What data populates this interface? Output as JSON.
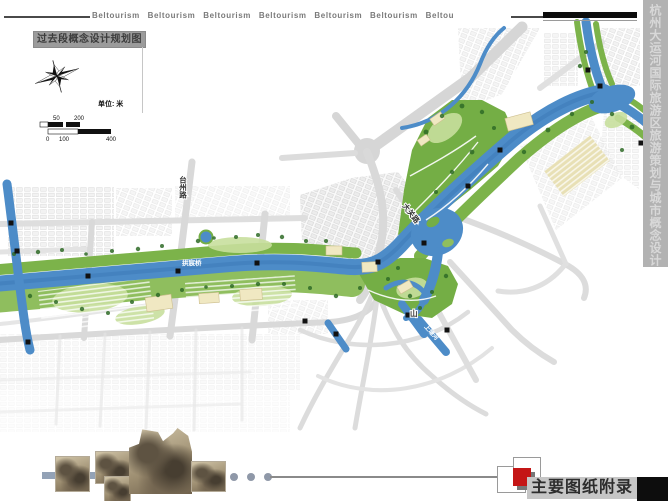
{
  "page": {
    "width": 668,
    "height": 501
  },
  "header": {
    "brand_line": "Beltourism Beltourism Beltourism Beltourism Beltourism Beltourism Beltou"
  },
  "title_box": {
    "label": "过去段概念设计规划图"
  },
  "sidebar": {
    "vertical_title": "杭州大运河国际旅游区旅游策划与城市概念设计"
  },
  "scalebar": {
    "unit_label": "单位: 米",
    "ticks": {
      "t0": "0",
      "t50": "50",
      "t100": "100",
      "t200": "200",
      "t400": "400"
    }
  },
  "map_labels": {
    "road_taizhou": "台州路",
    "road_daguan": "大关路",
    "road_shan": "山",
    "canal_bridge": "拱宸桥",
    "river_branch": "上塘河"
  },
  "footer": {
    "appendix_title": "主要图纸附录"
  },
  "colors": {
    "canal_blue": "#4d8cc8",
    "park_green": "#79b24a",
    "road_gray": "#d9d9d9",
    "accent_red": "#c41616",
    "sidebar_gray": "#b2b2b2"
  }
}
